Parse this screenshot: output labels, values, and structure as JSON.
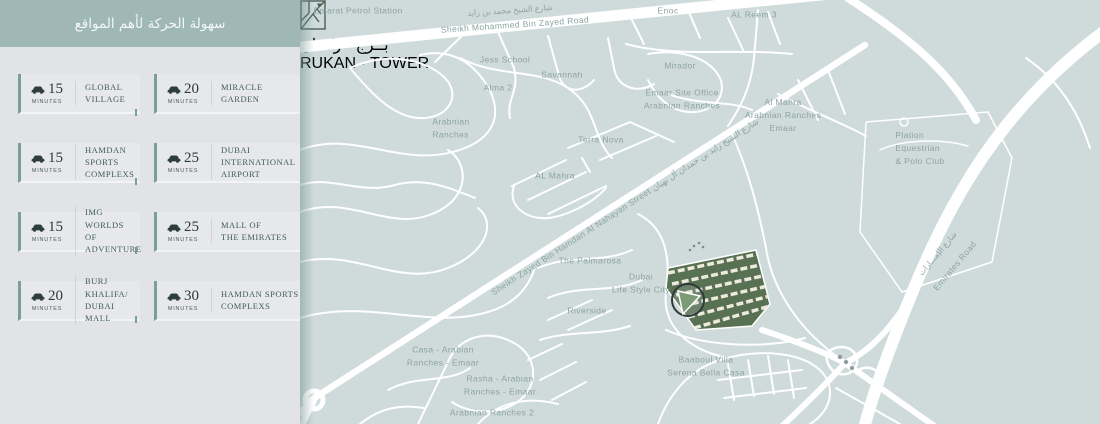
{
  "sidebar": {
    "title_ar": "سهولة الحركة لأهم المواقع",
    "cards": [
      {
        "minutes": "15",
        "unit": "MINUTES",
        "label": "GLOBAL\nVILLAGE"
      },
      {
        "minutes": "20",
        "unit": "MINUTES",
        "label": "MIRACLE\nGARDEN"
      },
      {
        "minutes": "15",
        "unit": "MINUTES",
        "label": "HAMDAN SPORTS\nCOMPLEXS"
      },
      {
        "minutes": "25",
        "unit": "MINUTES",
        "label": "DUBAI INTERNATIONAL\nAIRPORT"
      },
      {
        "minutes": "15",
        "unit": "MINUTES",
        "label": "IMG WORLDS\nOF ADVENTURE"
      },
      {
        "minutes": "25",
        "unit": "MINUTES",
        "label": "MALL OF\nTHE EMIRATES"
      },
      {
        "minutes": "20",
        "unit": "MINUTES",
        "label": "BURJ KHALIFA/\nDUBAI MALL"
      },
      {
        "minutes": "30",
        "unit": "MINUTES",
        "label": "HAMDAN SPORTS\nCOMPLEXS"
      }
    ]
  },
  "map": {
    "labels": [
      {
        "text": "Emarat Petrol Station"
      },
      {
        "text": "شارع الشيخ محمد بن زايد"
      },
      {
        "text": "Sheikh Mohammed Bin Zayed  Road"
      },
      {
        "text": "Enoc"
      },
      {
        "text": "AL Reem 3"
      },
      {
        "text": "Jess School"
      },
      {
        "text": "Savannah"
      },
      {
        "text": "Alma 2"
      },
      {
        "text": "Mirador"
      },
      {
        "text": "Emaar Site Office\nArabnian Ranches"
      },
      {
        "text": "Al Mahra\nArabnian Ranches\nEmaar"
      },
      {
        "text": "Arabnian\nRanches"
      },
      {
        "text": "Terra Nova"
      },
      {
        "text": "AL Mahra"
      },
      {
        "text": "Plation\nEquestrian\n& Polo Club"
      },
      {
        "text": "Sheikh Zayed Bin Hamdan Al Nahayan Street شارع الشيخ زايد بن حمدان آل نهيان"
      },
      {
        "text": "The Palmarosa"
      },
      {
        "text": "Dubai\nLife Style City"
      },
      {
        "text": "Riverside"
      },
      {
        "text": "Casa - Arabian\nRanches - Emaar"
      },
      {
        "text": "Rasha - Arabian\nRanches - Emaar"
      },
      {
        "text": "Arabnian Ranches 2"
      },
      {
        "text": "Baaboul Villa\nSerena Bella Casa"
      },
      {
        "text": "شارع الإمـــارات"
      },
      {
        "text": "Emirates Road"
      }
    ],
    "logo": {
      "arabic": "بــرج · ركــان",
      "english": "RUKAN · TOWER"
    }
  },
  "colors": {
    "header_bg": "#9fb8b7",
    "sidebar_bg": "#e2e3e5",
    "accent_teal": "#7a9e9c",
    "map_bg": "#cfdbda",
    "road_white": "#ffffff",
    "development_green": "#587153",
    "label_gray_teal": "#8ba3a2",
    "logo_green": "#4b5f53"
  }
}
